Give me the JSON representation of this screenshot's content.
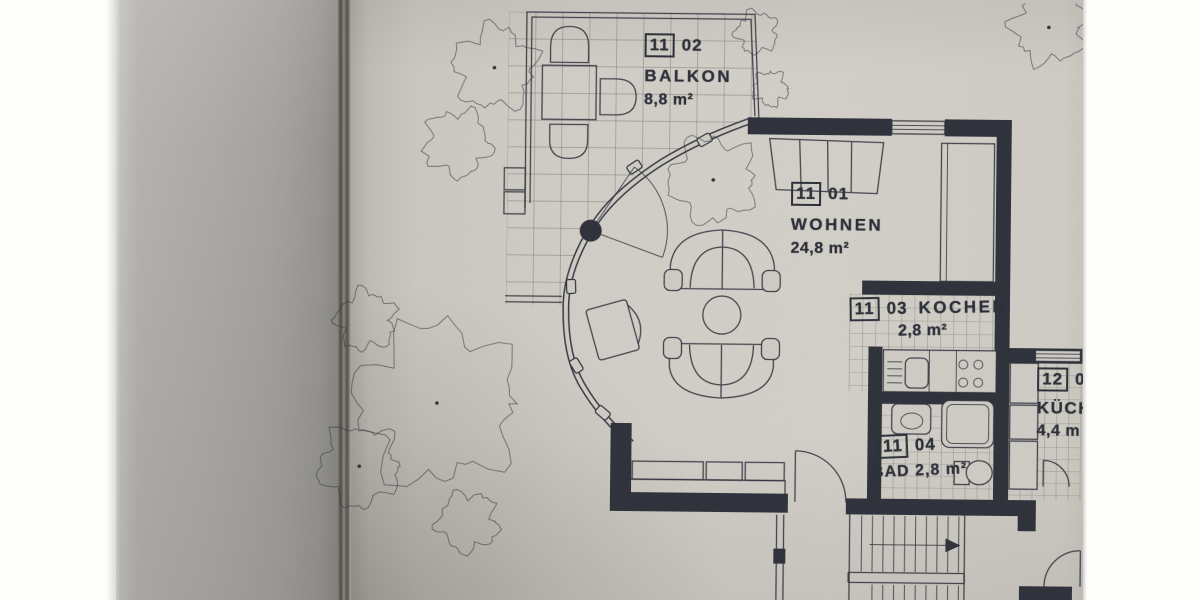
{
  "rooms": [
    {
      "unit": "11",
      "number": "02",
      "name": "BALKON",
      "area": "8,8 m²"
    },
    {
      "unit": "11",
      "number": "01",
      "name": "WOHNEN",
      "area": "24,8 m²"
    },
    {
      "unit": "11",
      "number": "03",
      "name": "KOCHEN",
      "area": "2,8 m²"
    },
    {
      "unit": "11",
      "number": "04",
      "name": "BAD",
      "area": "2,8 m²"
    },
    {
      "unit": "12",
      "number": "02",
      "name": "KÜCH",
      "area": "4,4 m"
    }
  ],
  "colors": {
    "ink": "#2e313a",
    "paper": "#cfccc5",
    "grid_line": "#8f8c84",
    "page_stack": "#a8a6a3",
    "background": "#fdfdfc"
  }
}
